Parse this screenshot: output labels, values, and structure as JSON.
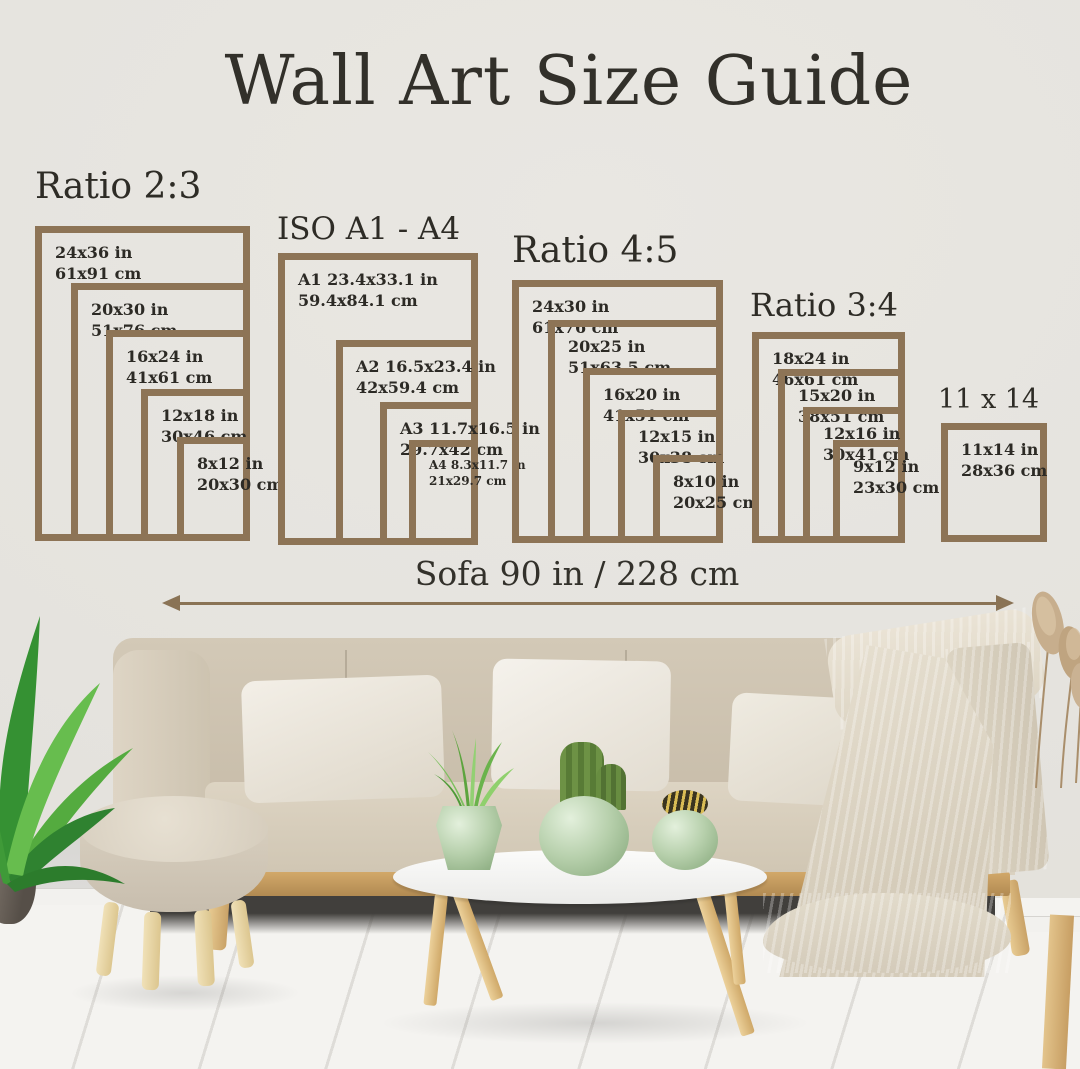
{
  "title": "Wall Art Size Guide",
  "groups": [
    {
      "heading": "Ratio 2:3",
      "frames": [
        {
          "inches": "24x36 in",
          "cm": "61x91 cm"
        },
        {
          "inches": "20x30 in",
          "cm": "51x76 cm"
        },
        {
          "inches": "16x24 in",
          "cm": "41x61 cm"
        },
        {
          "inches": "12x18 in",
          "cm": "30x46 cm"
        },
        {
          "inches": "8x12 in",
          "cm": "20x30 cm"
        }
      ]
    },
    {
      "heading": "ISO A1 - A4",
      "frames": [
        {
          "inches": "A1 23.4x33.1 in",
          "cm": "59.4x84.1 cm"
        },
        {
          "inches": "A2 16.5x23.4 in",
          "cm": "42x59.4 cm"
        },
        {
          "inches": "A3 11.7x16.5 in",
          "cm": "29.7x42 cm"
        },
        {
          "inches": "A4 8.3x11.7 in",
          "cm": "21x29.7 cm"
        }
      ]
    },
    {
      "heading": "Ratio 4:5",
      "frames": [
        {
          "inches": "24x30 in",
          "cm": "61x76 cm"
        },
        {
          "inches": "20x25 in",
          "cm": "51x63.5 cm"
        },
        {
          "inches": "16x20 in",
          "cm": "41x51 cm"
        },
        {
          "inches": "12x15 in",
          "cm": "30x38 cm"
        },
        {
          "inches": "8x10 in",
          "cm": "20x25 cm"
        }
      ]
    },
    {
      "heading": "Ratio 3:4",
      "frames": [
        {
          "inches": "18x24 in",
          "cm": "46x61 cm"
        },
        {
          "inches": "15x20 in",
          "cm": "38x51 cm"
        },
        {
          "inches": "12x16 in",
          "cm": "30x41 cm"
        },
        {
          "inches": "9x12 in",
          "cm": "23x30 cm"
        }
      ]
    },
    {
      "heading": "11 x 14",
      "frames": [
        {
          "inches": "11x14 in",
          "cm": "28x36 cm"
        }
      ]
    }
  ],
  "sofa": {
    "width_label": "Sofa 90 in / 228 cm"
  },
  "colors": {
    "frame_border": "#8d7456",
    "arrow": "#8a7355",
    "heading_text": "#2e2c26",
    "wall": "#e7e5e0"
  }
}
